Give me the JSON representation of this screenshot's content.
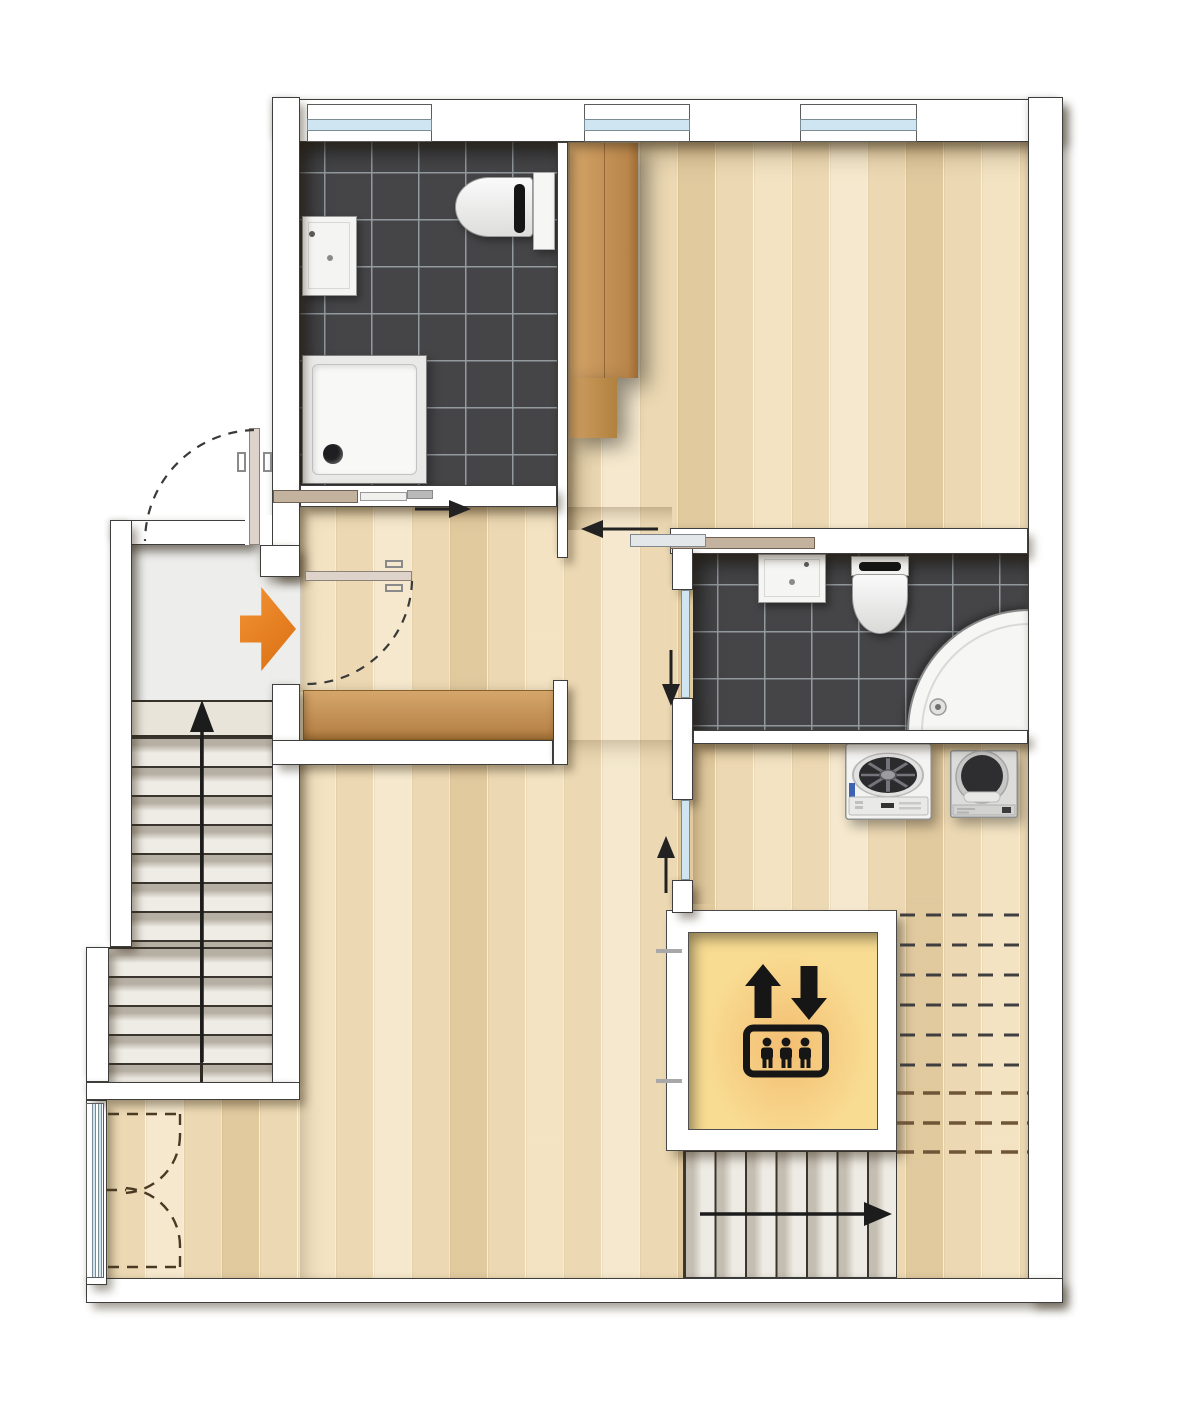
{
  "meta": {
    "type": "floor-plan",
    "view": "top-down apartment plan, no text labels"
  },
  "colors": {
    "wall-fill": "#ffffff",
    "wall-line": "#3e3e3e",
    "parquet-base": "#ecd9b3",
    "tile-floor": "#454547",
    "tile-grout": "#969ea3",
    "landing-floor": "#ededeb",
    "tread-light": "#efece5",
    "tread-dark": "#b6afa3",
    "furniture-wood": "#c79a5e",
    "furniture-wood-dark": "#a97c42",
    "elevator-cab": "#f8dc92",
    "elevator-glow": "#eb8c3c",
    "icon-black": "#161616",
    "glass-blue": "#cfe6f2",
    "frame-gray": "#7c8c94",
    "fixture-white": "#f5f5f4",
    "fixture-line": "#969696",
    "arrow-black": "#222222",
    "entrance-orange": "#e8821c",
    "dash-black": "#3f3f3f",
    "dash-brown": "#6f5638",
    "door-leaf": "#ded3ca",
    "door-rail-tan": "#c3b39e"
  },
  "rooms": [
    {
      "id": "bathroom-top-left",
      "floor": "dark-tile",
      "fixtures": [
        "washbasin",
        "toilet",
        "shower-tray"
      ],
      "door": "sliding",
      "windows": 1
    },
    {
      "id": "bedroom",
      "floor": "parquet",
      "furniture": [
        "wardrobe"
      ],
      "door": "sliding",
      "windows": 2
    },
    {
      "id": "hallway",
      "floor": "parquet",
      "furniture": [
        "sideboard"
      ],
      "entrance": true
    },
    {
      "id": "bathroom-right",
      "floor": "dark-tile",
      "fixtures": [
        "washbasin",
        "toilet",
        "corner-shower"
      ],
      "door": "sliding-glass"
    },
    {
      "id": "laundry",
      "floor": "parquet",
      "appliances": [
        "washing-machine",
        "tumble-dryer"
      ],
      "door": "sliding-glass"
    },
    {
      "id": "living-area",
      "floor": "parquet",
      "features": [
        "french-window",
        "overhead-stair-dashes"
      ]
    },
    {
      "id": "elevator",
      "symbol": "elevator-pictogram-up-down-passengers"
    },
    {
      "id": "staircase-west",
      "indicator": "arrow-up"
    },
    {
      "id": "staircase-south",
      "indicator": "arrow-right"
    },
    {
      "id": "entrance-landing",
      "indicator": "orange-entrance-arrow"
    }
  ],
  "indicators": {
    "entrance-arrow": {
      "direction": "right",
      "color": "#e8821c"
    },
    "door-arrows": [
      {
        "at": "bathroom-top-left",
        "direction": "right"
      },
      {
        "at": "bedroom",
        "direction": "left"
      },
      {
        "at": "bathroom-right",
        "direction": "down"
      },
      {
        "at": "laundry",
        "direction": "up"
      },
      {
        "at": "staircase-west",
        "direction": "up"
      },
      {
        "at": "staircase-south",
        "direction": "right"
      }
    ]
  }
}
